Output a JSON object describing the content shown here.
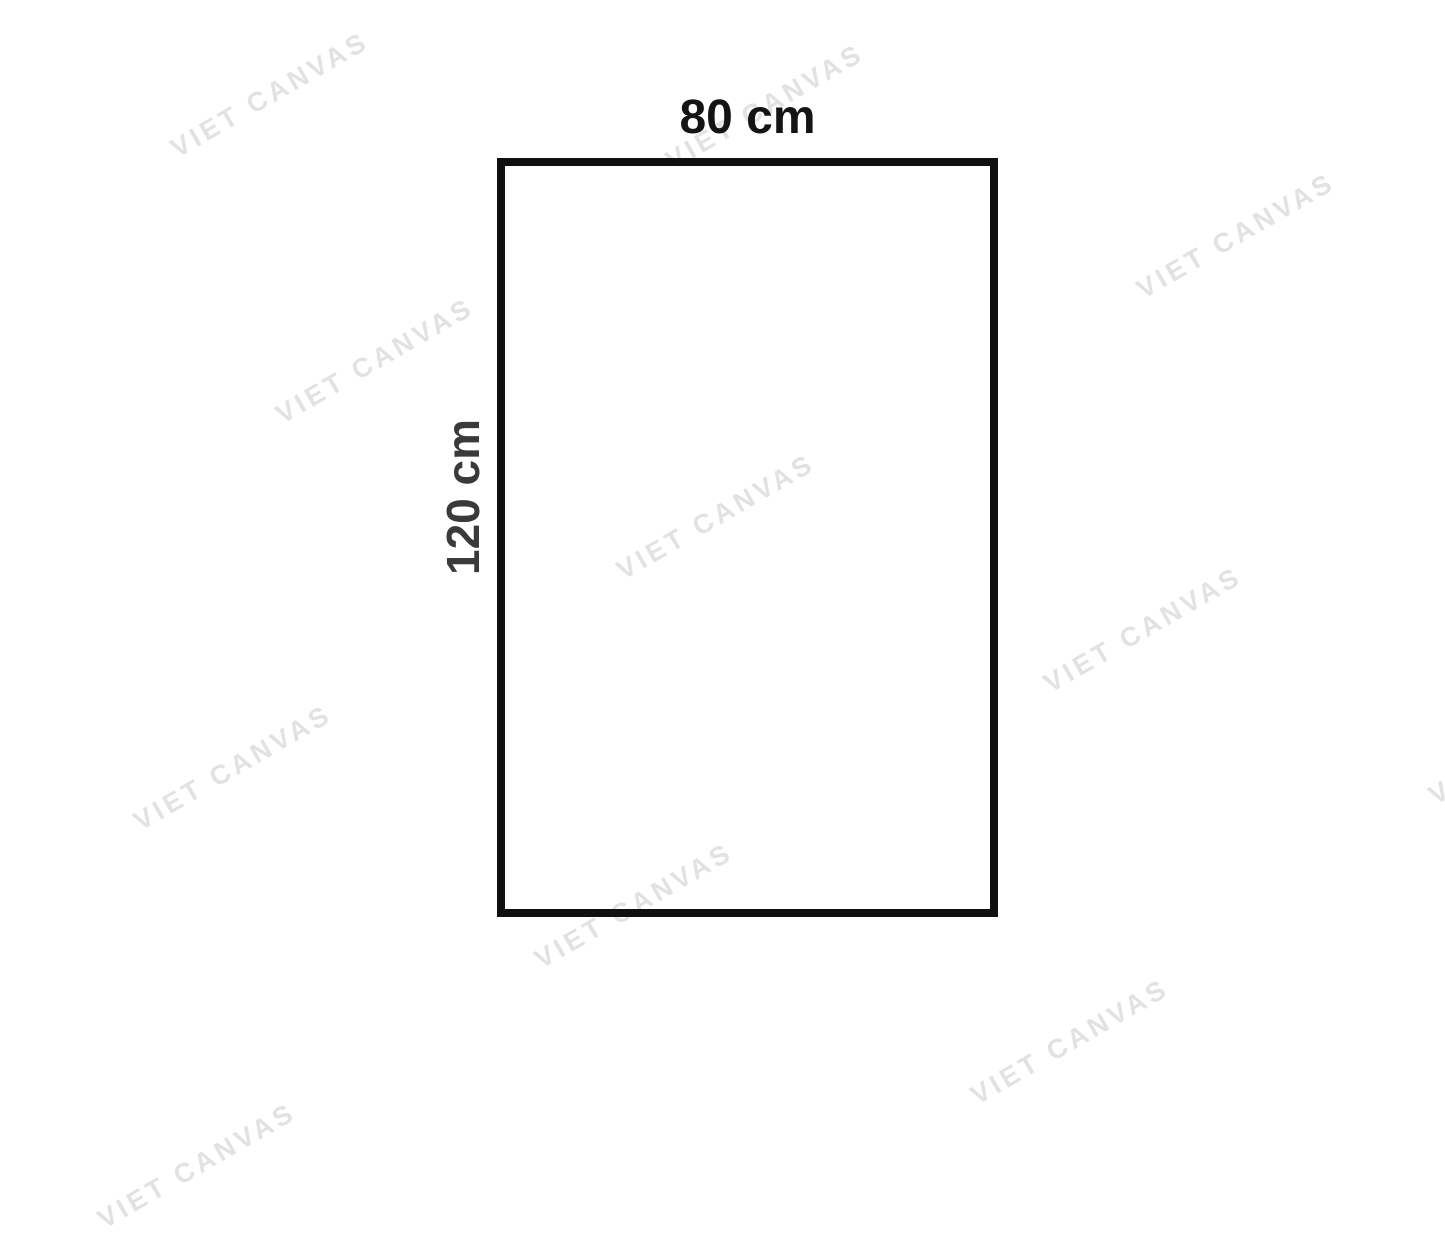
{
  "diagram": {
    "width_label": "80 cm",
    "height_label": "120 cm",
    "width_label_color": "#141414",
    "height_label_color": "#3a3a3a",
    "rectangle_border_color": "#101010",
    "background_color": "#ffffff"
  },
  "watermark": {
    "text": "VIET CANVAS",
    "color": "#e2e2e2",
    "rotation_deg": -30,
    "positions": [
      {
        "x": 270,
        "y": 95
      },
      {
        "x": 765,
        "y": 107
      },
      {
        "x": 1236,
        "y": 236
      },
      {
        "x": 375,
        "y": 361
      },
      {
        "x": 716,
        "y": 517
      },
      {
        "x": 1143,
        "y": 630
      },
      {
        "x": 233,
        "y": 768
      },
      {
        "x": 634,
        "y": 906
      },
      {
        "x": 1070,
        "y": 1042
      },
      {
        "x": 197,
        "y": 1166
      },
      {
        "x": 1528,
        "y": 742
      }
    ]
  }
}
